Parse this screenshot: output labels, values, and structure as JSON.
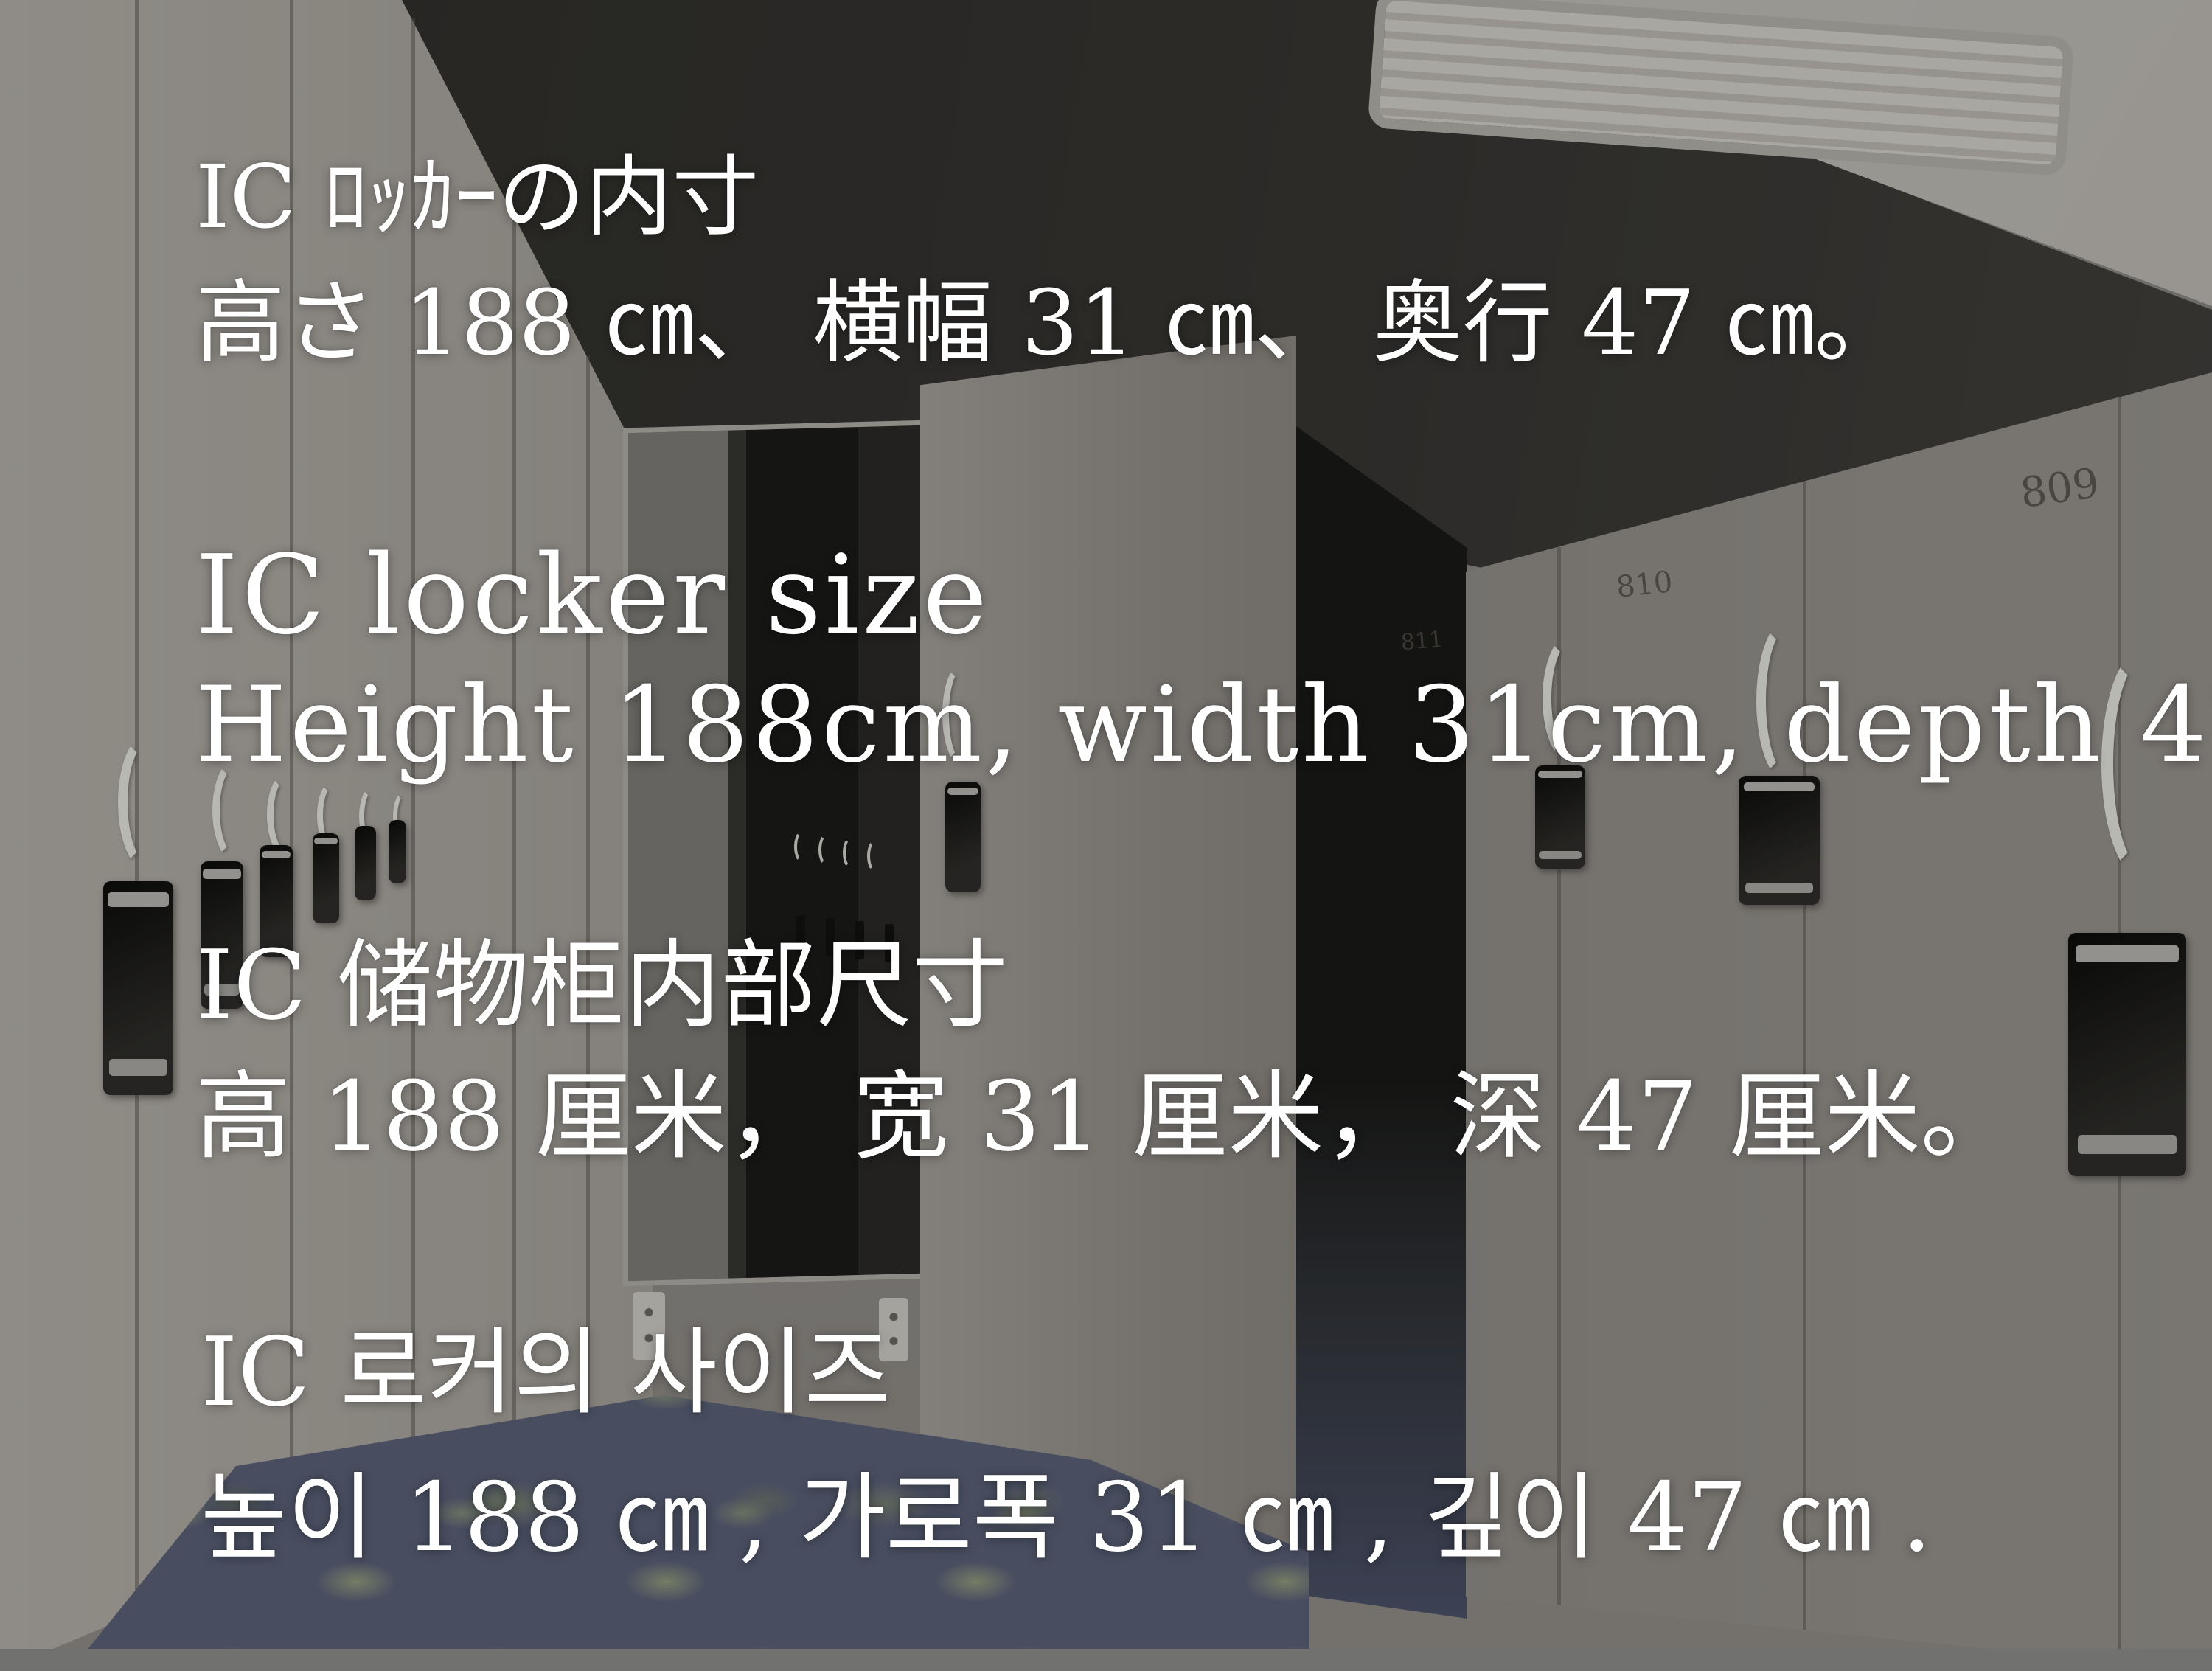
{
  "overlay": {
    "japanese": {
      "title": "IC ﾛｯｶｰの内寸",
      "dimensions": "高さ 188 ㎝、 横幅 31 ㎝、 奥行 47 ㎝。"
    },
    "english": {
      "title": "IC locker size",
      "dimensions": "Height 188cm, width 31cm, depth 47cm."
    },
    "chinese": {
      "title": "IC 储物柜内部尺寸",
      "dimensions": "高 188 厘米， 宽 31 厘米， 深 47 厘米。"
    },
    "korean": {
      "title": "IC 로커의 사이즈",
      "dimensions": "높이 188 ㎝ , 가로폭 31 ㎝ , 깊이 47 ㎝ ."
    }
  },
  "locker_numbers": {
    "far_right": "809",
    "mid_right": "810",
    "partial": "811"
  },
  "palette": {
    "overlay_text": "#ffffff",
    "lock_black": "#0d0d0c",
    "locker_light": "#a9a5a0",
    "back_wall_dark": "#2e2d2b",
    "carpet_blue": "#59617a",
    "carpet_speckle": "#9aa37f"
  }
}
